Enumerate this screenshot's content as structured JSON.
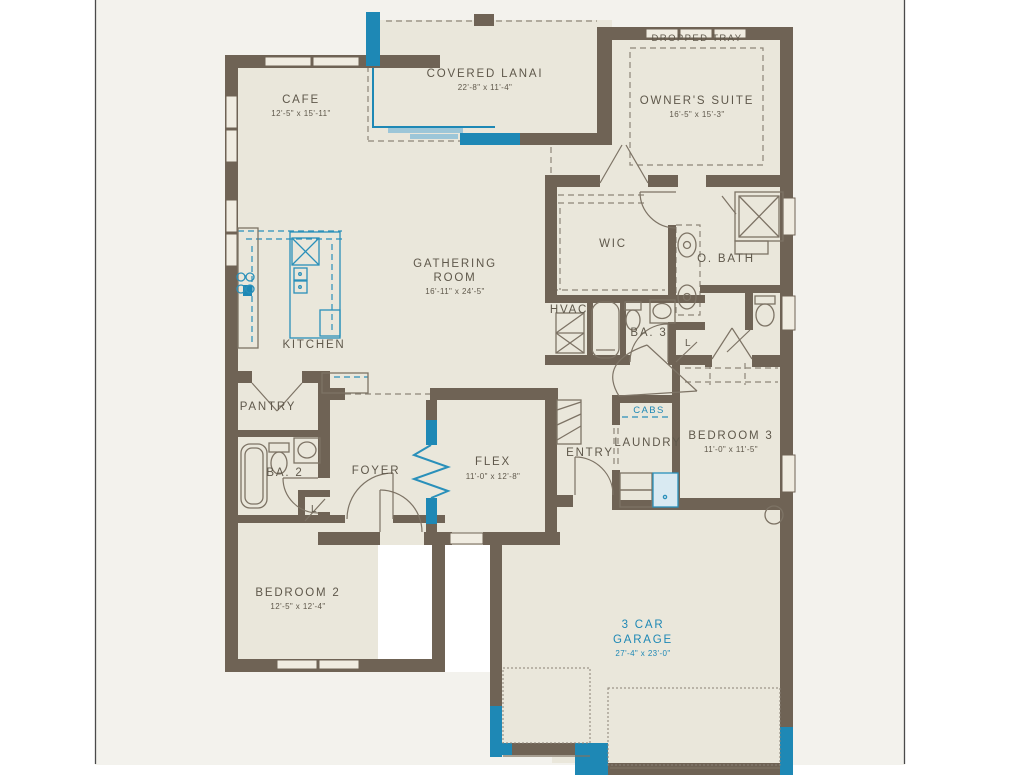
{
  "colors": {
    "wall": "#6f6355",
    "accent_teal": "#1e88b5",
    "label_text": "#5f584b",
    "room_fill": "#eae7db",
    "background": "#f3f2ed"
  },
  "rooms": {
    "cafe": {
      "name": "CAFE",
      "dims": "12'-5\" x 15'-11\""
    },
    "covered_lanai": {
      "name": "COVERED LANAI",
      "dims": "22'-8\" x 11'-4\""
    },
    "owners_suite": {
      "name": "OWNER'S SUITE",
      "dims": "16'-5\" x 15'-3\"",
      "ceiling": "DROPPED TRAY"
    },
    "gathering_room": {
      "name_line1": "GATHERING",
      "name_line2": "ROOM",
      "dims": "16'-11\" x 24'-5\""
    },
    "kitchen": {
      "name": "KITCHEN"
    },
    "pantry": {
      "name": "PANTRY"
    },
    "wic": {
      "name": "WIC"
    },
    "owners_bath": {
      "name": "O. BATH"
    },
    "hvac": {
      "name": "HVAC"
    },
    "bath3": {
      "name": "BA. 3"
    },
    "bath2": {
      "name": "BA. 2"
    },
    "foyer": {
      "name": "FOYER"
    },
    "flex": {
      "name": "FLEX",
      "dims": "11'-0\" x 12'-8\""
    },
    "entry": {
      "name": "ENTRY"
    },
    "laundry": {
      "name": "LAUNDRY",
      "cabinets": "CABS"
    },
    "bedroom3": {
      "name": "BEDROOM 3",
      "dims": "11'-0\" x 11'-5\""
    },
    "bedroom2": {
      "name": "BEDROOM 2",
      "dims": "12'-5\" x 12'-4\""
    },
    "garage": {
      "name_line1": "3 CAR",
      "name_line2": "GARAGE",
      "dims": "27'-4\" x 23'-0\""
    },
    "linen_closet": {
      "abbr": "L"
    }
  }
}
